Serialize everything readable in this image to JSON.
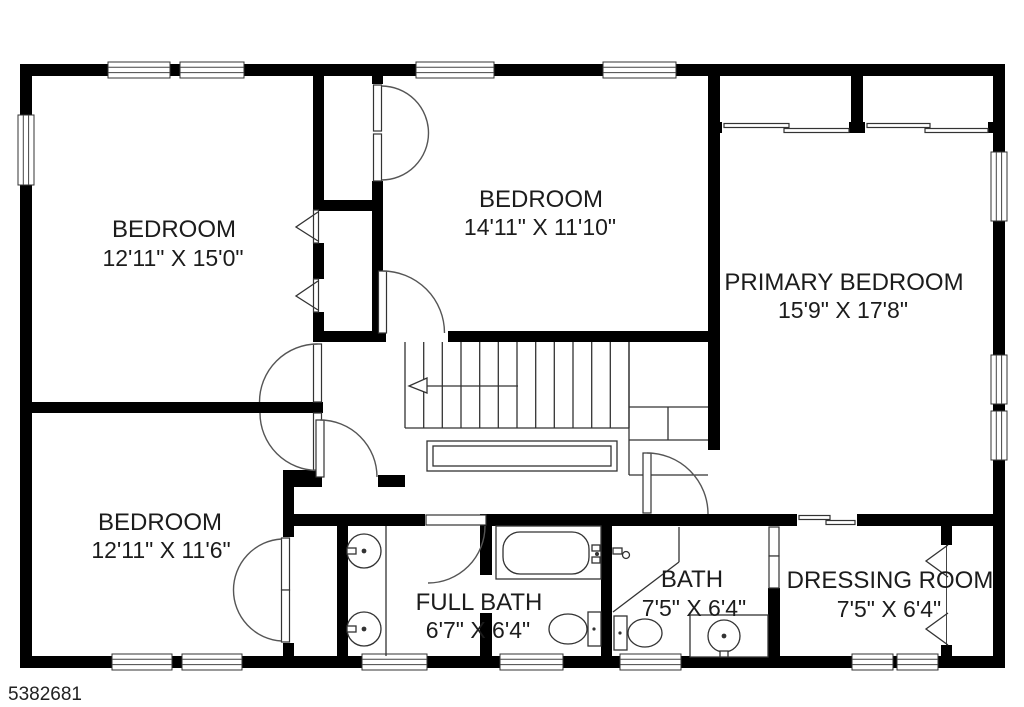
{
  "page": {
    "background": "#ffffff",
    "listing_id": "5382681"
  },
  "colors": {
    "wall": "#000000",
    "line": "#333333",
    "text": "#1c1c1c",
    "background": "#ffffff"
  },
  "rooms": [
    {
      "name": "BEDROOM",
      "dims": "12'11\" X 15'0\""
    },
    {
      "name": "BEDROOM",
      "dims": "14'11\" X 11'10\""
    },
    {
      "name": "PRIMARY BEDROOM",
      "dims": "15'9\" X 17'8\""
    },
    {
      "name": "BEDROOM",
      "dims": "12'11\" X 11'6\""
    },
    {
      "name": "FULL BATH",
      "dims": "6'7\" X 6'4\""
    },
    {
      "name": "BATH",
      "dims": "7'5\" X 6'4\""
    },
    {
      "name": "DRESSING ROOM",
      "dims": "7'5\" X 6'4\""
    }
  ],
  "icons": {
    "stairs_direction": "up-arrow-left"
  }
}
